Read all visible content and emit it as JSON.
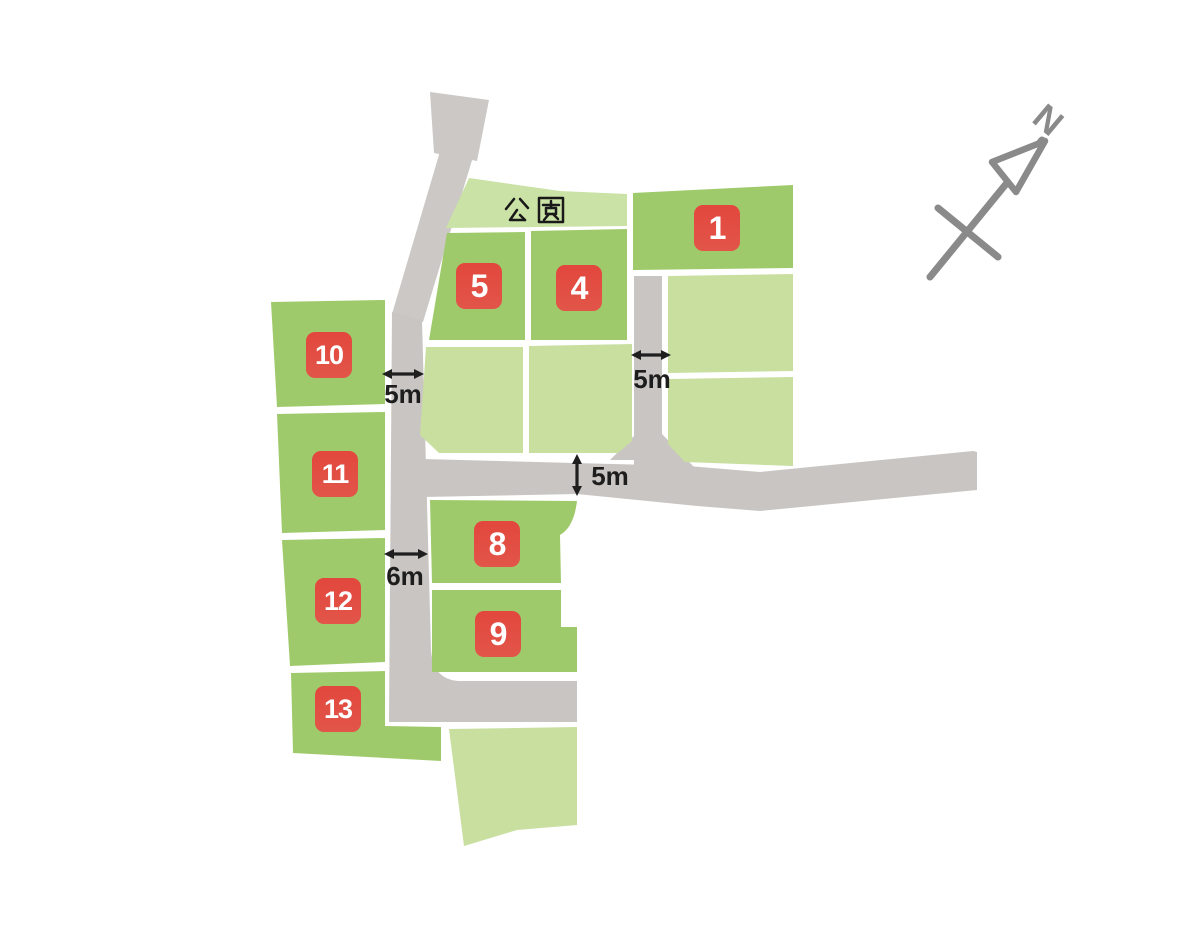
{
  "map": {
    "type": "residential-lot-map",
    "park": {
      "label": "公園"
    },
    "compass": {
      "label": "N",
      "direction": "north-upper-right"
    },
    "lots": [
      {
        "number": "1"
      },
      {
        "number": "4"
      },
      {
        "number": "5"
      },
      {
        "number": "8"
      },
      {
        "number": "9"
      },
      {
        "number": "10"
      },
      {
        "number": "11"
      },
      {
        "number": "12"
      },
      {
        "number": "13"
      }
    ],
    "unnumbered_light_lots": 6,
    "dimensions": [
      {
        "label": "5m",
        "orientation": "horizontal",
        "location": "west-road-upper"
      },
      {
        "label": "5m",
        "orientation": "horizontal",
        "location": "center-vertical-road"
      },
      {
        "label": "5m",
        "orientation": "vertical",
        "location": "middle-road"
      },
      {
        "label": "6m",
        "orientation": "horizontal",
        "location": "west-road-lower"
      }
    ],
    "colors": {
      "road_gray": "#c9c5c2",
      "lot_green": "#9fca6b",
      "lot_light_green": "#c8dfa0",
      "park_green": "#cae2a6",
      "badge_red": "#e2473d",
      "badge_text": "#ffffff",
      "dimension_text": "#1d1d1d",
      "compass_gray": "#8a8a8a",
      "background": "#ffffff"
    }
  }
}
